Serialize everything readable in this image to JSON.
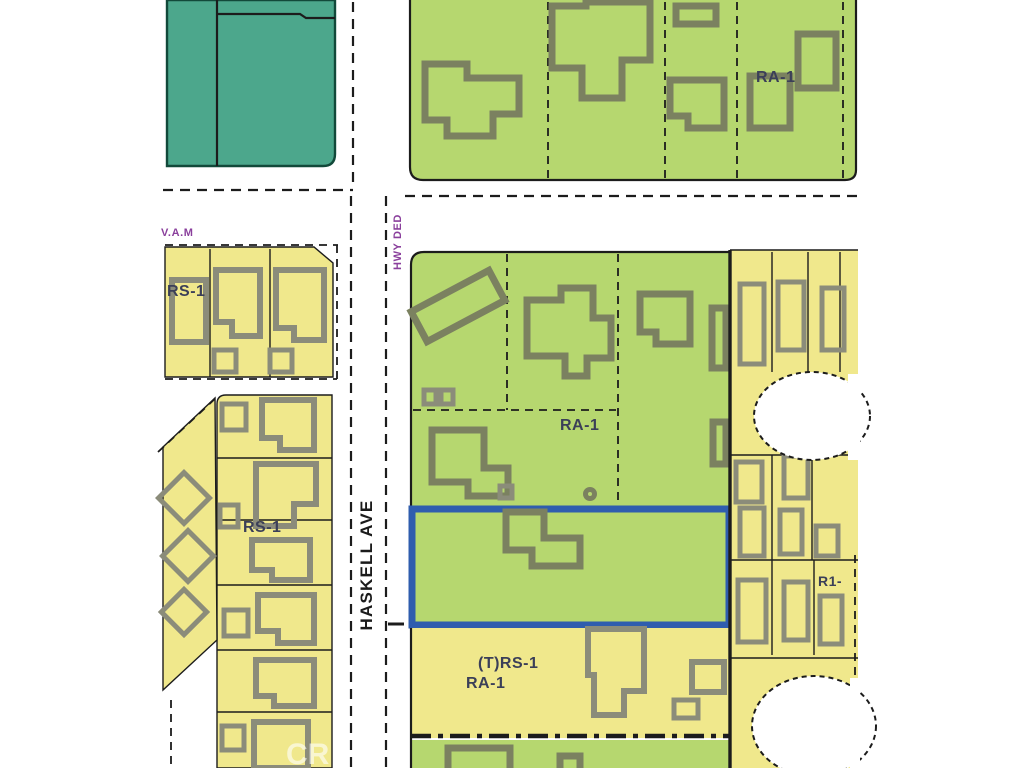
{
  "map_title": "zoning-parcel-map",
  "streets": {
    "haskell_ave": "HASKELL AVE",
    "hwy_ded": "HWY DED",
    "vam": "V.A.M"
  },
  "zone_labels": {
    "ra1_top_right": "RA-1",
    "ra1_center": "RA-1",
    "rs1_upper_left": "RS-1",
    "rs1_left": "RS-1",
    "trs1_bottom": "(T)RS-1",
    "ra1_bottom": "RA-1",
    "r1_right": "R1-"
  },
  "watermark": "CR",
  "colors": {
    "zone-green": "#b6d76f",
    "zone-yellow": "#f0e88c",
    "zone-teal": "#4ca78c",
    "building-green": "#7b8160",
    "building-yellow": "#8b8c7a",
    "line": "#1c1c1c",
    "parcel-blue": "#2f5dae",
    "street-text": "#1b1b1b",
    "zone-text": "#3b3f58",
    "annotation-purple": "#8a3f9c"
  }
}
